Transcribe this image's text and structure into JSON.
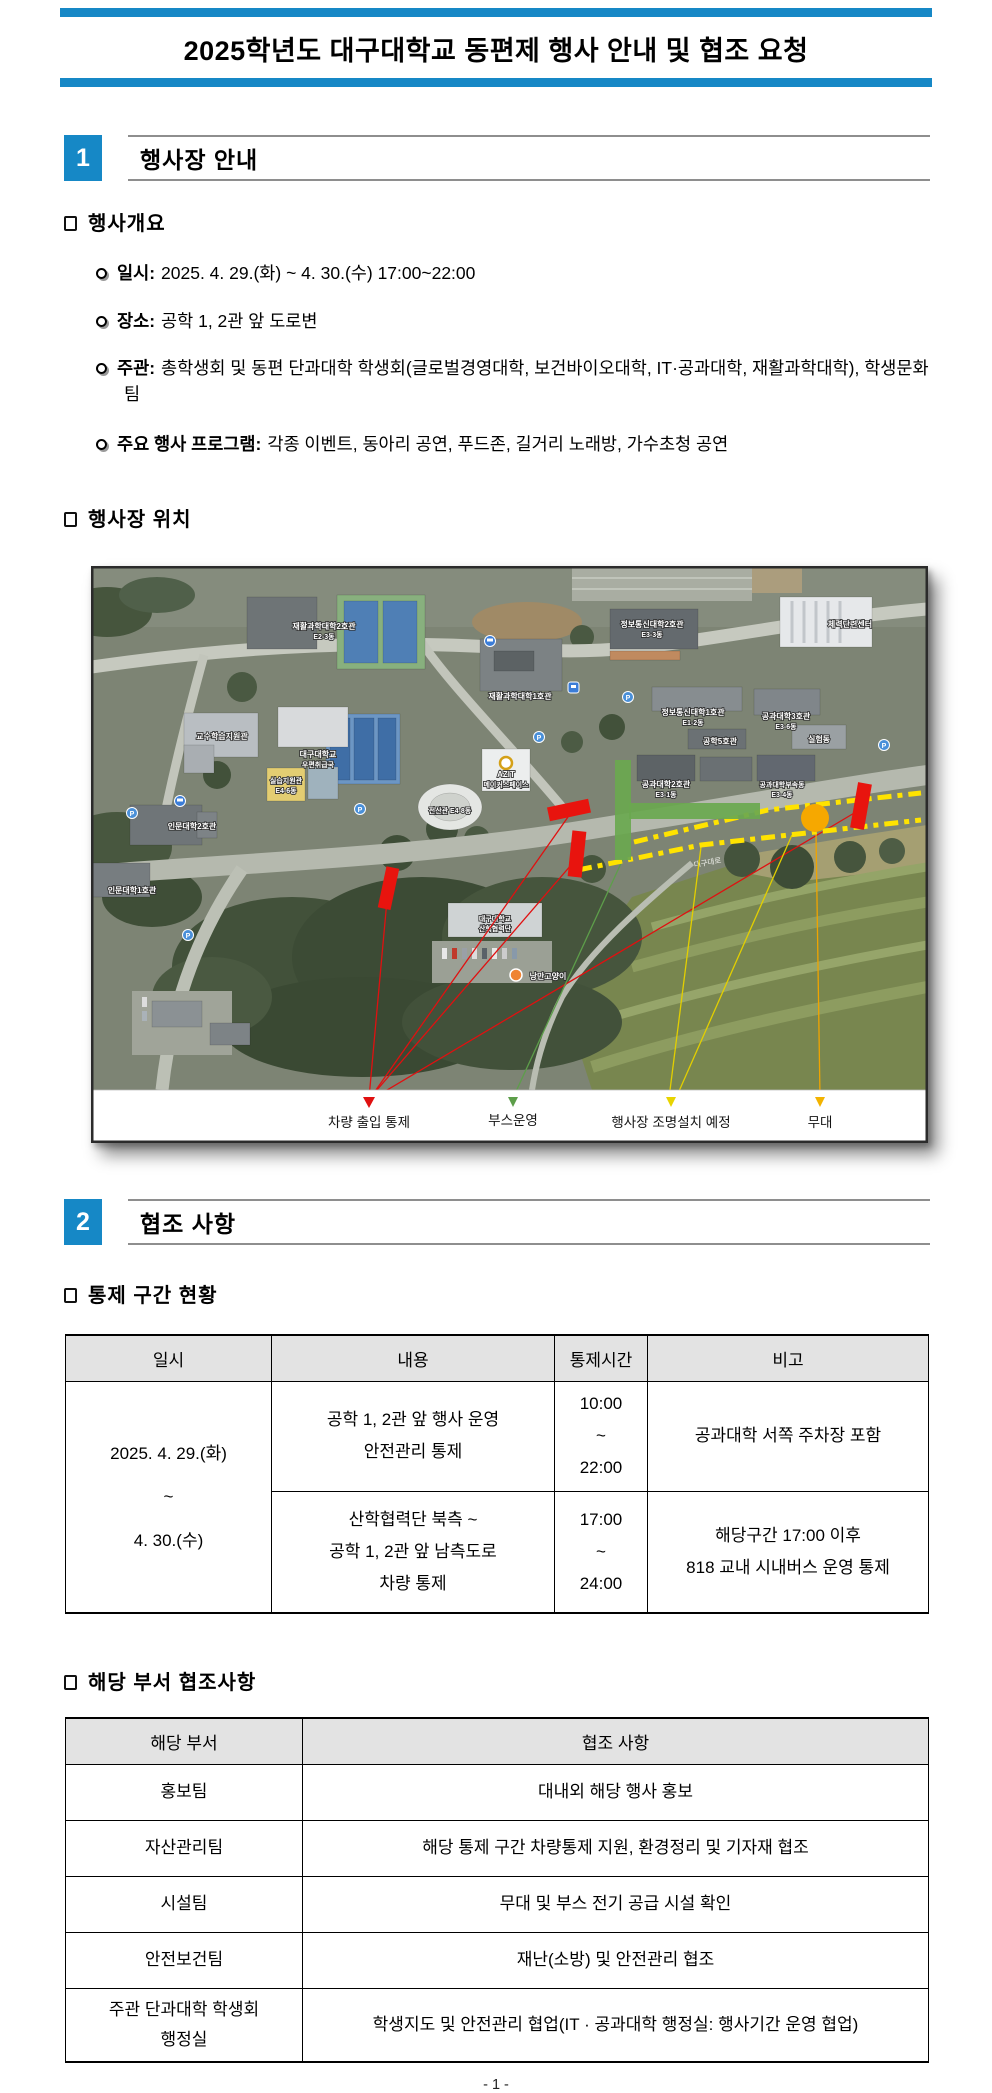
{
  "accent_color": "#1688C6",
  "title": "2025학년도 대구대학교 동편제 행사 안내 및 협조 요청",
  "section1": {
    "number": "1",
    "heading": "행사장 안내",
    "overview_heading": "행사개요",
    "bullets": [
      {
        "label": "일시:",
        "value": "2025. 4. 29.(화) ~ 4. 30.(수) 17:00~22:00"
      },
      {
        "label": "장소:",
        "value": "공학 1, 2관 앞 도로변"
      },
      {
        "label": "주관:",
        "value": "총학생회 및 동편 단과대학 학생회(글로벌경영대학, 보건바이오대학, IT·공과대학, 재활과학대학), 학생문화팀"
      },
      {
        "label": "주요 행사 프로그램:",
        "value": "각종 이벤트, 동아리 공연, 푸드존, 길거리 노래방, 가수초청 공연"
      }
    ],
    "location_heading": "행사장 위치"
  },
  "map": {
    "legend": [
      {
        "label": "차량 출입 통제",
        "color": "#E8140E"
      },
      {
        "label": "부스운영",
        "color": "#6AA84F"
      },
      {
        "label": "행사장 조명설치 예정",
        "color": "#F5D400"
      },
      {
        "label": "무대",
        "color": "#F6A800"
      }
    ],
    "labels": {
      "rehab2": "재활과학대학2호관",
      "rehab2b": "E2-3동",
      "rehab1": "재활과학대학1호관",
      "it2": "정보통신대학2호관",
      "it2b": "E3-3동",
      "it1": "정보통신대학1호관",
      "it1b": "E1-2동",
      "eng3": "공과대학3호관",
      "eng3b": "E3-6동",
      "eng5": "공학5호관",
      "lab": "실험동",
      "training": "체력단련센터",
      "teach": "교수학습지원관",
      "post1": "대구대학교",
      "post2": "우편취급국",
      "prac1": "실습지원관",
      "prac2": "E4-6동",
      "eng2": "공과대학2호관",
      "eng2b": "E3-1동",
      "annex1": "공과대학부속동",
      "annex2": "E3-4동",
      "azit1": "AZIT",
      "azit2": "메이커스페이스",
      "comp": "전산관 E4-8동",
      "hum2": "인문대학2호관",
      "hum1": "인문대학1호관",
      "coop1": "대구대학교",
      "coop2": "산학협력단",
      "cat": "낭만고양이",
      "road": "대구대로"
    }
  },
  "section2": {
    "number": "2",
    "heading": "협조 사항",
    "control_heading": "통제 구간 현황",
    "control_table": {
      "col_datetime": "일시",
      "col_content": "내용",
      "col_time": "통제시간",
      "col_note": "비고",
      "datetime": "2025. 4. 29.(화)\n~\n4. 30.(수)",
      "row1_content": "공학 1, 2관 앞 행사 운영\n안전관리 통제",
      "row1_time": "10:00\n~\n22:00",
      "row1_note": "공과대학 서쪽 주차장 포함",
      "row2_content": "산학협력단 북측 ~\n공학 1, 2관 앞 남측도로\n차량 통제",
      "row2_time": "17:00\n~\n24:00",
      "row2_note": "해당구간 17:00 이후\n818 교내 시내버스 운영 통제"
    },
    "dept_heading": "해당 부서 협조사항",
    "dept_table": {
      "col_dept": "해당 부서",
      "col_coop": "협조 사항",
      "rows": [
        {
          "dept": "홍보팀",
          "coop": "대내외 해당 행사 홍보"
        },
        {
          "dept": "자산관리팀",
          "coop": "해당 통제 구간 차량통제 지원, 환경정리 및 기자재 협조"
        },
        {
          "dept": "시설팀",
          "coop": "무대 및 부스 전기 공급 시설 확인"
        },
        {
          "dept": "안전보건팀",
          "coop": "재난(소방) 및 안전관리 협조"
        },
        {
          "dept": "주관 단과대학 학생회\n행정실",
          "coop": "학생지도 및 안전관리 협업(IT · 공과대학 행정실: 행사기간 운영 협업)"
        }
      ]
    }
  },
  "footer": "- 1 -"
}
